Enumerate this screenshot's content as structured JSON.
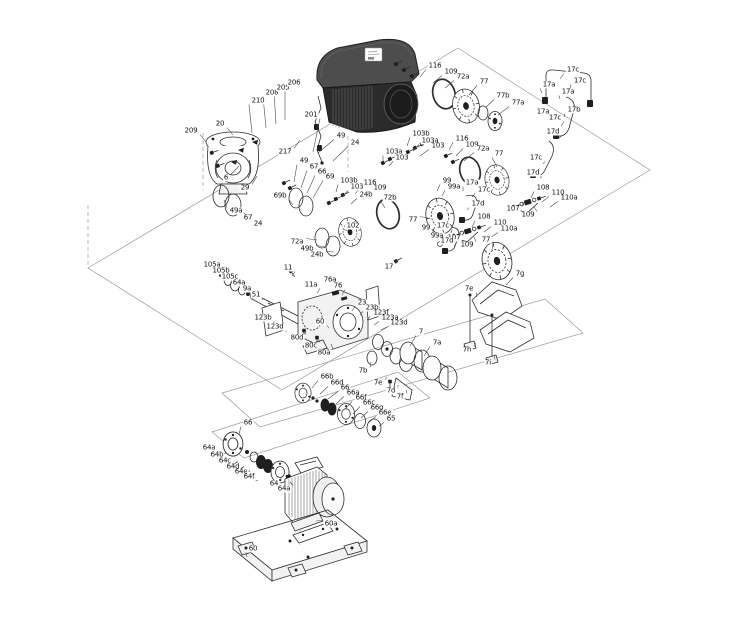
{
  "diagram": {
    "type": "exploded-parts-drawing",
    "subject": "pump assembly with drive motor, shaft, couplings, flanges and baseplate",
    "background": "#ffffff",
    "ink_color": "#2e2e2e",
    "label_color": "#111111",
    "label_font_size": 7
  },
  "labels": [
    {
      "t": "209",
      "x": 191,
      "y": 131,
      "u": 206,
      "v": 142
    },
    {
      "t": "20",
      "x": 220,
      "y": 124,
      "u": 233,
      "v": 135
    },
    {
      "t": "210",
      "x": 258,
      "y": 101,
      "u": 252,
      "v": 133
    },
    {
      "t": "208",
      "x": 272,
      "y": 93,
      "u": 266,
      "v": 128
    },
    {
      "t": "205",
      "x": 283,
      "y": 88,
      "u": 276,
      "v": 124
    },
    {
      "t": "206",
      "x": 294,
      "y": 83,
      "u": 285,
      "v": 120
    },
    {
      "t": "201",
      "x": 311,
      "y": 115,
      "u": 313,
      "v": 152
    },
    {
      "t": "217",
      "x": 285,
      "y": 152,
      "u": 300,
      "v": 140
    },
    {
      "t": "6",
      "x": 226,
      "y": 178,
      "u": 239,
      "v": 166
    },
    {
      "t": "29",
      "x": 245,
      "y": 188,
      "u": 257,
      "v": 176
    },
    {
      "t": "49",
      "x": 341,
      "y": 136,
      "u": 318,
      "v": 153
    },
    {
      "t": "24",
      "x": 355,
      "y": 143,
      "u": 333,
      "v": 161
    },
    {
      "t": "49",
      "x": 304,
      "y": 161,
      "u": 294,
      "v": 182
    },
    {
      "t": "67",
      "x": 314,
      "y": 167,
      "u": 301,
      "v": 188
    },
    {
      "t": "66",
      "x": 322,
      "y": 172,
      "u": 307,
      "v": 193
    },
    {
      "t": "69",
      "x": 330,
      "y": 177,
      "u": 313,
      "v": 198
    },
    {
      "t": "69b",
      "x": 280,
      "y": 196,
      "u": 293,
      "v": 205
    },
    {
      "t": "49a",
      "x": 236,
      "y": 211,
      "u": 224,
      "v": 200
    },
    {
      "t": "67",
      "x": 248,
      "y": 218,
      "u": 234,
      "v": 207
    },
    {
      "t": "24",
      "x": 258,
      "y": 224,
      "u": 243,
      "v": 212
    },
    {
      "t": "102",
      "x": 353,
      "y": 226,
      "u": 347,
      "v": 231
    },
    {
      "t": "72a",
      "x": 297,
      "y": 242,
      "u": 317,
      "v": 240
    },
    {
      "t": "49b",
      "x": 307,
      "y": 249,
      "u": 326,
      "v": 247
    },
    {
      "t": "24b",
      "x": 317,
      "y": 255,
      "u": 334,
      "v": 252
    },
    {
      "t": "103b",
      "x": 349,
      "y": 181,
      "u": 336,
      "v": 192
    },
    {
      "t": "103",
      "x": 357,
      "y": 187,
      "u": 342,
      "v": 197
    },
    {
      "t": "116",
      "x": 370,
      "y": 183,
      "u": 355,
      "v": 194
    },
    {
      "t": "109",
      "x": 380,
      "y": 188,
      "u": 363,
      "v": 199
    },
    {
      "t": "24b",
      "x": 366,
      "y": 195,
      "u": 351,
      "v": 204
    },
    {
      "t": "72b",
      "x": 390,
      "y": 198,
      "u": 385,
      "v": 208
    },
    {
      "t": "103a",
      "x": 394,
      "y": 152,
      "u": 383,
      "v": 161
    },
    {
      "t": "103",
      "x": 402,
      "y": 158,
      "u": 389,
      "v": 166
    },
    {
      "t": "103b",
      "x": 421,
      "y": 134,
      "u": 407,
      "v": 146
    },
    {
      "t": "103a",
      "x": 430,
      "y": 141,
      "u": 413,
      "v": 151
    },
    {
      "t": "103",
      "x": 438,
      "y": 146,
      "u": 420,
      "v": 156
    },
    {
      "t": "116",
      "x": 462,
      "y": 139,
      "u": 449,
      "v": 150
    },
    {
      "t": "109",
      "x": 472,
      "y": 145,
      "u": 456,
      "v": 156
    },
    {
      "t": "72a",
      "x": 483,
      "y": 149,
      "u": 464,
      "v": 161
    },
    {
      "t": "116",
      "x": 435,
      "y": 66,
      "u": 420,
      "v": 77
    },
    {
      "t": "109",
      "x": 451,
      "y": 72,
      "u": 433,
      "v": 83
    },
    {
      "t": "72a",
      "x": 463,
      "y": 77,
      "u": 445,
      "v": 88
    },
    {
      "t": "77",
      "x": 484,
      "y": 82,
      "u": 469,
      "v": 95
    },
    {
      "t": "77b",
      "x": 503,
      "y": 96,
      "u": 486,
      "v": 107
    },
    {
      "t": "77a",
      "x": 518,
      "y": 103,
      "u": 498,
      "v": 115
    },
    {
      "t": "17c",
      "x": 573,
      "y": 70,
      "u": 560,
      "v": 79
    },
    {
      "t": "17a",
      "x": 549,
      "y": 85,
      "u": 542,
      "v": 93
    },
    {
      "t": "17c",
      "x": 580,
      "y": 81,
      "u": 570,
      "v": 89
    },
    {
      "t": "17a",
      "x": 568,
      "y": 92,
      "u": 560,
      "v": 99
    },
    {
      "t": "17b",
      "x": 574,
      "y": 110,
      "u": 564,
      "v": 117
    },
    {
      "t": "17a",
      "x": 543,
      "y": 112,
      "u": 552,
      "v": 119
    },
    {
      "t": "17c",
      "x": 555,
      "y": 118,
      "u": 561,
      "v": 126
    },
    {
      "t": "17d",
      "x": 553,
      "y": 132,
      "u": 558,
      "v": 139
    },
    {
      "t": "17c",
      "x": 536,
      "y": 158,
      "u": 543,
      "v": 164
    },
    {
      "t": "17d",
      "x": 533,
      "y": 173,
      "u": 540,
      "v": 178
    },
    {
      "t": "77",
      "x": 499,
      "y": 154,
      "u": 497,
      "v": 167
    },
    {
      "t": "99",
      "x": 447,
      "y": 181,
      "u": 437,
      "v": 191
    },
    {
      "t": "99a",
      "x": 454,
      "y": 187,
      "u": 442,
      "v": 196
    },
    {
      "t": "17a",
      "x": 472,
      "y": 183,
      "u": 463,
      "v": 191
    },
    {
      "t": "17c",
      "x": 484,
      "y": 190,
      "u": 472,
      "v": 197
    },
    {
      "t": "17d",
      "x": 478,
      "y": 204,
      "u": 467,
      "v": 210
    },
    {
      "t": "108",
      "x": 543,
      "y": 188,
      "u": 531,
      "v": 198
    },
    {
      "t": "110",
      "x": 558,
      "y": 193,
      "u": 542,
      "v": 202
    },
    {
      "t": "110a",
      "x": 569,
      "y": 198,
      "u": 550,
      "v": 207
    },
    {
      "t": "107",
      "x": 513,
      "y": 209,
      "u": 523,
      "v": 203
    },
    {
      "t": "109",
      "x": 528,
      "y": 215,
      "u": 534,
      "v": 207
    },
    {
      "t": "77",
      "x": 413,
      "y": 220,
      "u": 428,
      "v": 218
    },
    {
      "t": "99",
      "x": 426,
      "y": 228,
      "u": 433,
      "v": 236
    },
    {
      "t": "99a",
      "x": 437,
      "y": 236,
      "u": 443,
      "v": 243
    },
    {
      "t": "108",
      "x": 484,
      "y": 217,
      "u": 472,
      "v": 227
    },
    {
      "t": "110",
      "x": 500,
      "y": 223,
      "u": 484,
      "v": 232
    },
    {
      "t": "110a",
      "x": 509,
      "y": 229,
      "u": 491,
      "v": 237
    },
    {
      "t": "107",
      "x": 454,
      "y": 238,
      "u": 464,
      "v": 232
    },
    {
      "t": "109",
      "x": 467,
      "y": 245,
      "u": 474,
      "v": 237
    },
    {
      "t": "77",
      "x": 486,
      "y": 240,
      "u": 492,
      "v": 250
    },
    {
      "t": "17c",
      "x": 443,
      "y": 226,
      "u": 451,
      "v": 233
    },
    {
      "t": "17d",
      "x": 447,
      "y": 241,
      "u": 454,
      "v": 246
    },
    {
      "t": "17",
      "x": 389,
      "y": 267,
      "u": 397,
      "v": 259
    },
    {
      "t": "7g",
      "x": 520,
      "y": 274,
      "u": 506,
      "v": 285
    },
    {
      "t": "7e",
      "x": 469,
      "y": 289,
      "u": 477,
      "v": 297
    },
    {
      "t": "7h",
      "x": 467,
      "y": 350,
      "u": 476,
      "v": 343
    },
    {
      "t": "7i",
      "x": 488,
      "y": 363,
      "u": 494,
      "v": 355
    },
    {
      "t": "105a",
      "x": 212,
      "y": 265,
      "u": 221,
      "v": 273
    },
    {
      "t": "105b",
      "x": 221,
      "y": 271,
      "u": 228,
      "v": 278
    },
    {
      "t": "105c",
      "x": 230,
      "y": 277,
      "u": 235,
      "v": 283
    },
    {
      "t": "64a",
      "x": 239,
      "y": 283,
      "u": 243,
      "v": 288
    },
    {
      "t": "9a",
      "x": 247,
      "y": 289,
      "u": 250,
      "v": 293
    },
    {
      "t": "51",
      "x": 256,
      "y": 295,
      "u": 262,
      "v": 300
    },
    {
      "t": "11",
      "x": 288,
      "y": 268,
      "u": 292,
      "v": 276
    },
    {
      "t": "11a",
      "x": 311,
      "y": 285,
      "u": 317,
      "v": 293
    },
    {
      "t": "76a",
      "x": 330,
      "y": 280,
      "u": 335,
      "v": 289
    },
    {
      "t": "76",
      "x": 338,
      "y": 286,
      "u": 342,
      "v": 295
    },
    {
      "t": "23",
      "x": 362,
      "y": 303,
      "u": 352,
      "v": 311
    },
    {
      "t": "23b",
      "x": 372,
      "y": 308,
      "u": 360,
      "v": 315
    },
    {
      "t": "123f",
      "x": 381,
      "y": 313,
      "u": 367,
      "v": 320
    },
    {
      "t": "123a",
      "x": 390,
      "y": 318,
      "u": 374,
      "v": 325
    },
    {
      "t": "123d",
      "x": 399,
      "y": 323,
      "u": 381,
      "v": 330
    },
    {
      "t": "123b",
      "x": 263,
      "y": 318,
      "u": 274,
      "v": 324
    },
    {
      "t": "123d",
      "x": 275,
      "y": 327,
      "u": 286,
      "v": 332
    },
    {
      "t": "60",
      "x": 320,
      "y": 322,
      "u": 329,
      "v": 328
    },
    {
      "t": "80d",
      "x": 297,
      "y": 338,
      "u": 305,
      "v": 331
    },
    {
      "t": "80c",
      "x": 311,
      "y": 346,
      "u": 318,
      "v": 338
    },
    {
      "t": "80a",
      "x": 324,
      "y": 353,
      "u": 331,
      "v": 344
    },
    {
      "t": "7b",
      "x": 363,
      "y": 371,
      "u": 371,
      "v": 362
    },
    {
      "t": "7",
      "x": 421,
      "y": 332,
      "u": 410,
      "v": 346
    },
    {
      "t": "7a",
      "x": 437,
      "y": 343,
      "u": 424,
      "v": 356
    },
    {
      "t": "7e",
      "x": 378,
      "y": 383,
      "u": 387,
      "v": 377
    },
    {
      "t": "7d",
      "x": 391,
      "y": 391,
      "u": 398,
      "v": 385
    },
    {
      "t": "7f",
      "x": 400,
      "y": 397,
      "u": 406,
      "v": 390
    },
    {
      "t": "66b",
      "x": 327,
      "y": 377,
      "u": 312,
      "v": 388
    },
    {
      "t": "66d",
      "x": 337,
      "y": 383,
      "u": 320,
      "v": 394
    },
    {
      "t": "66",
      "x": 345,
      "y": 388,
      "u": 328,
      "v": 399
    },
    {
      "t": "66a",
      "x": 353,
      "y": 393,
      "u": 336,
      "v": 404
    },
    {
      "t": "66f",
      "x": 361,
      "y": 398,
      "u": 345,
      "v": 409
    },
    {
      "t": "66c",
      "x": 369,
      "y": 403,
      "u": 353,
      "v": 414
    },
    {
      "t": "66g",
      "x": 377,
      "y": 408,
      "u": 361,
      "v": 418
    },
    {
      "t": "66e",
      "x": 385,
      "y": 413,
      "u": 368,
      "v": 423
    },
    {
      "t": "65",
      "x": 391,
      "y": 419,
      "u": 379,
      "v": 426
    },
    {
      "t": "66",
      "x": 248,
      "y": 423,
      "u": 239,
      "v": 434
    },
    {
      "t": "64a",
      "x": 209,
      "y": 448,
      "u": 219,
      "v": 455
    },
    {
      "t": "64b",
      "x": 217,
      "y": 455,
      "u": 226,
      "v": 461
    },
    {
      "t": "64c",
      "x": 225,
      "y": 461,
      "u": 232,
      "v": 466
    },
    {
      "t": "64d",
      "x": 233,
      "y": 467,
      "u": 239,
      "v": 471
    },
    {
      "t": "64e",
      "x": 241,
      "y": 472,
      "u": 246,
      "v": 476
    },
    {
      "t": "64f",
      "x": 249,
      "y": 477,
      "u": 253,
      "v": 480
    },
    {
      "t": "64",
      "x": 274,
      "y": 484,
      "u": 281,
      "v": 477
    },
    {
      "t": "64a",
      "x": 284,
      "y": 489,
      "u": 290,
      "v": 482
    },
    {
      "t": "60a",
      "x": 331,
      "y": 524,
      "u": 316,
      "v": 521
    },
    {
      "t": "60",
      "x": 253,
      "y": 549,
      "u": 247,
      "v": 557
    }
  ]
}
